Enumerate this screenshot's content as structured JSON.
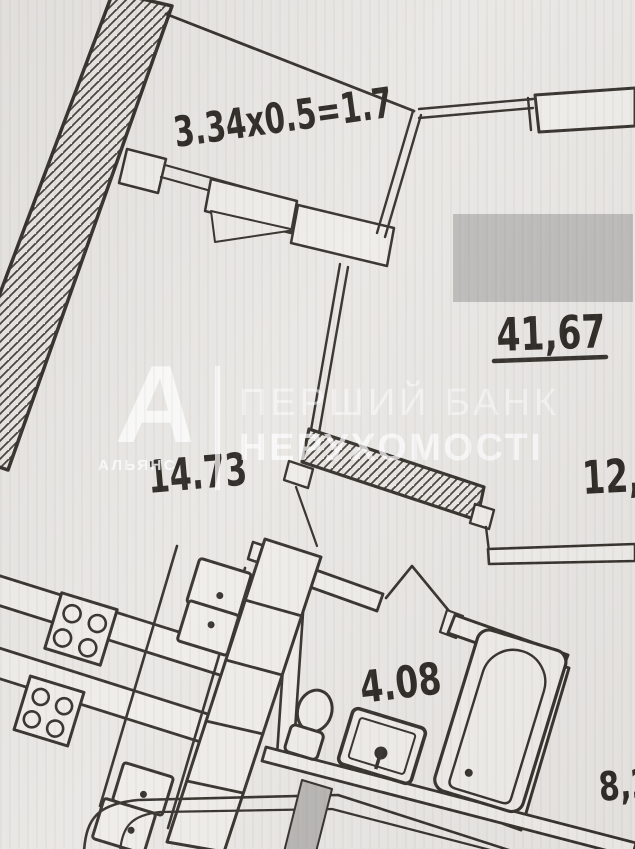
{
  "photo": {
    "paper_color": "#e9e7e4",
    "ink_color": "#332f2a",
    "censor_color": "#bcbbba",
    "watermark_color": "#ffffff"
  },
  "watermark": {
    "logo_letter": "А",
    "logo_caption": "АЛЬЯНС",
    "line1": "ПЕРШИЙ БАНК",
    "line2": "НЕРУХОМОСТІ"
  },
  "plan": {
    "labels": {
      "balcony_calc": "3.34x0.5=1.7",
      "total_area": "41,67",
      "room_main": "14.73",
      "room_right": "12,9",
      "bathroom": "4.08",
      "kitchen": "8,2"
    }
  }
}
